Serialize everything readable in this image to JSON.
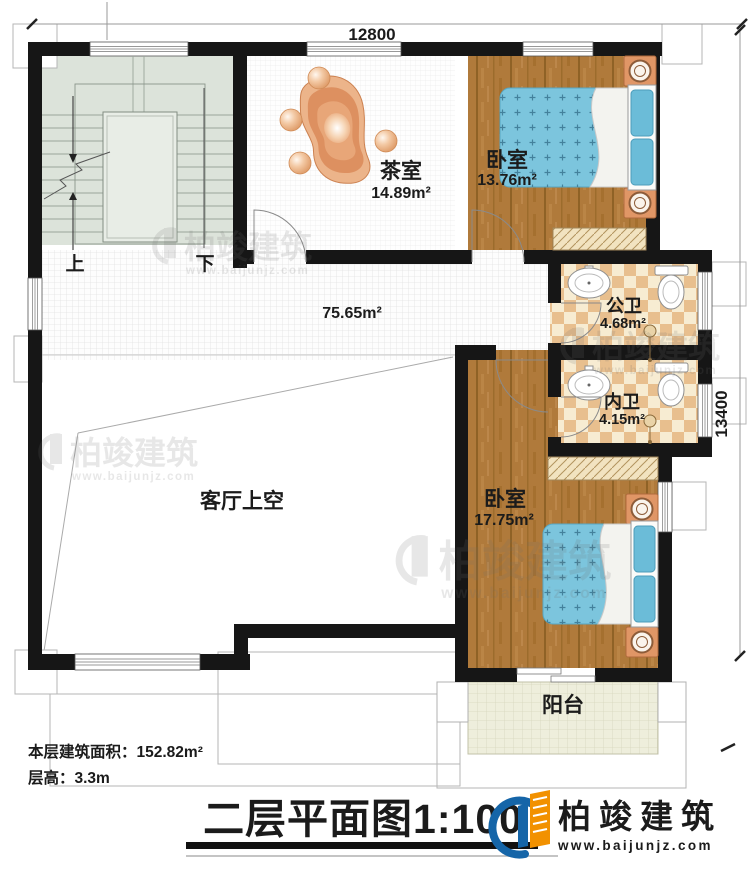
{
  "dims": {
    "top": "12800",
    "right": "13400"
  },
  "labels": {
    "up": "上",
    "down": "下",
    "corridor_area": "75.65m²",
    "living_void": "客厅上空",
    "balcony": "阳台"
  },
  "rooms": {
    "tea": {
      "name": "茶室",
      "area": "14.89m²"
    },
    "bedroom_top": {
      "name": "卧室",
      "area": "13.76m²"
    },
    "public_bath": {
      "name": "公卫",
      "area": "4.68m²"
    },
    "private_bath": {
      "name": "内卫",
      "area": "4.15m²"
    },
    "bedroom_bottom": {
      "name": "卧室",
      "area": "17.75m²"
    }
  },
  "stats": {
    "floor_area": "本层建筑面积：152.82m²",
    "floor_height": "层高：3.3m"
  },
  "titleblock": {
    "title": "二层平面图1:100"
  },
  "brand": {
    "name": "柏竣建筑",
    "url": "www.baijunjz.com"
  },
  "watermark": {
    "name": "柏竣建筑",
    "url": "www.baijunjz.com"
  },
  "colors": {
    "wall": "#161616",
    "wood": "#b07a3b",
    "bed_blue": "#7cc5dd",
    "tile": "#e8bf8e",
    "stair": "#dce3da",
    "balcony": "#eeeedc",
    "logo_blue": "#1565a8",
    "logo_orange": "#f29100"
  }
}
